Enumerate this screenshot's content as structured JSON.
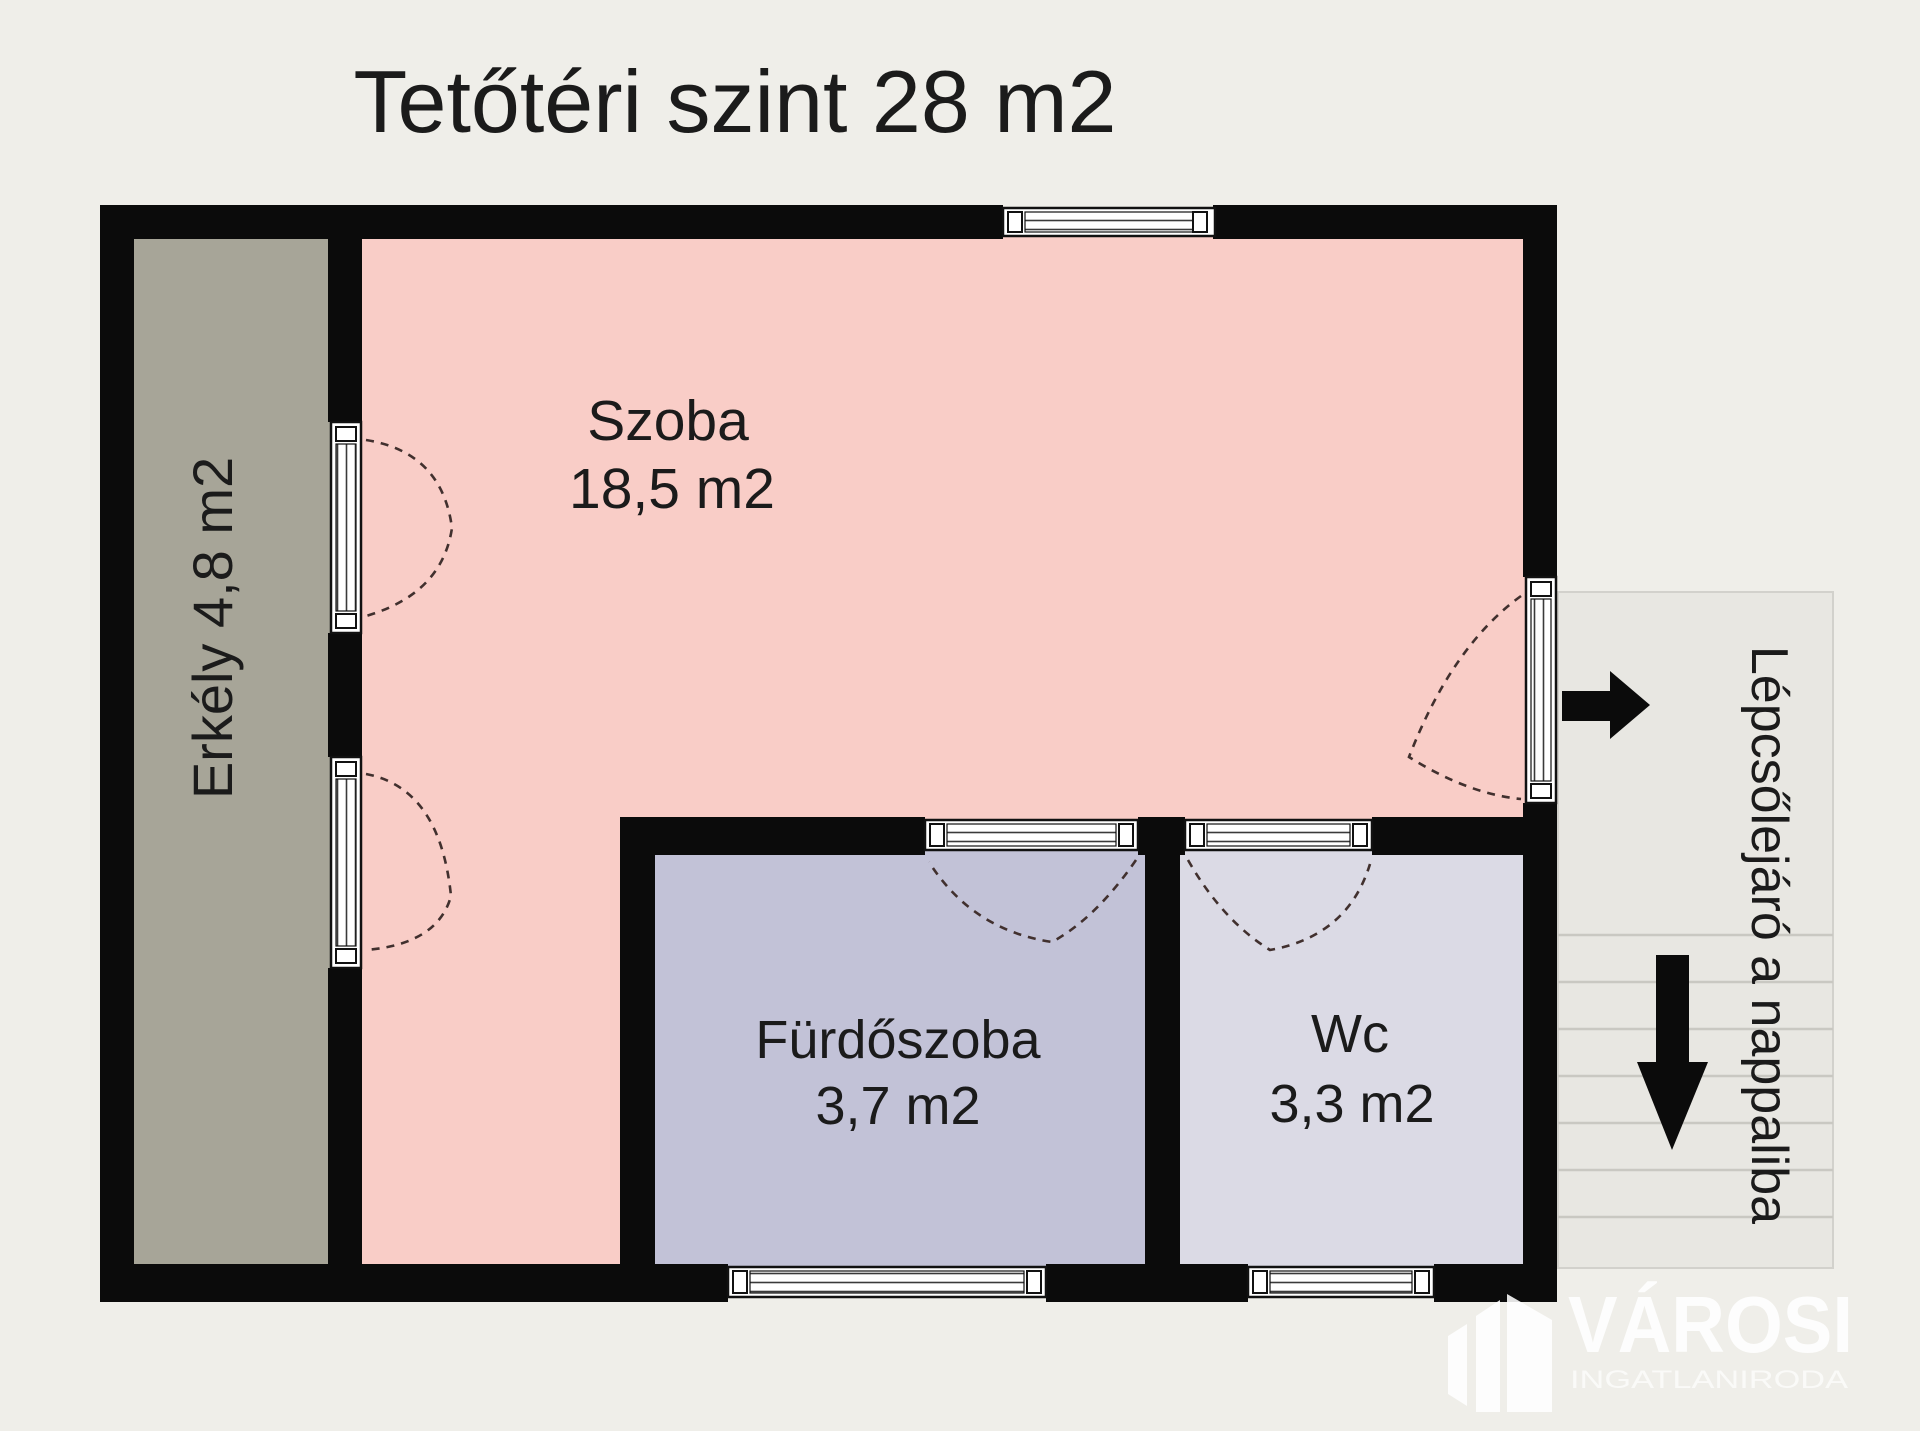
{
  "title": "Tetőtéri szint 28 m2",
  "rooms": {
    "szoba": {
      "name": "Szoba",
      "area": "18,5 m2"
    },
    "erkely": {
      "label": "Erkély 4,8 m2"
    },
    "furdoszoba": {
      "name": "Fürdőszoba",
      "area": "3,7 m2"
    },
    "wc": {
      "name": "Wc",
      "area": "3,3 m2"
    }
  },
  "stairs": {
    "label": "Lépcsőlejáró a nappaliba"
  },
  "watermark": {
    "brand": "VÁROSI",
    "subtitle": "INGATLANIRODA"
  },
  "icons": {
    "enter_direction": "arrow-right",
    "stairs_down": "arrow-down"
  },
  "colors": {
    "background": "#efeee9",
    "wall": "#0b0b0b",
    "szoba": "#f9cdc7",
    "erkely": "#a7a598",
    "furdoszoba": "#c2c2d7",
    "wc": "#dbdae5",
    "stairs_panel": "#e8e7e2",
    "arrow": "#0b0b0b",
    "text": "#1b1b1b"
  }
}
